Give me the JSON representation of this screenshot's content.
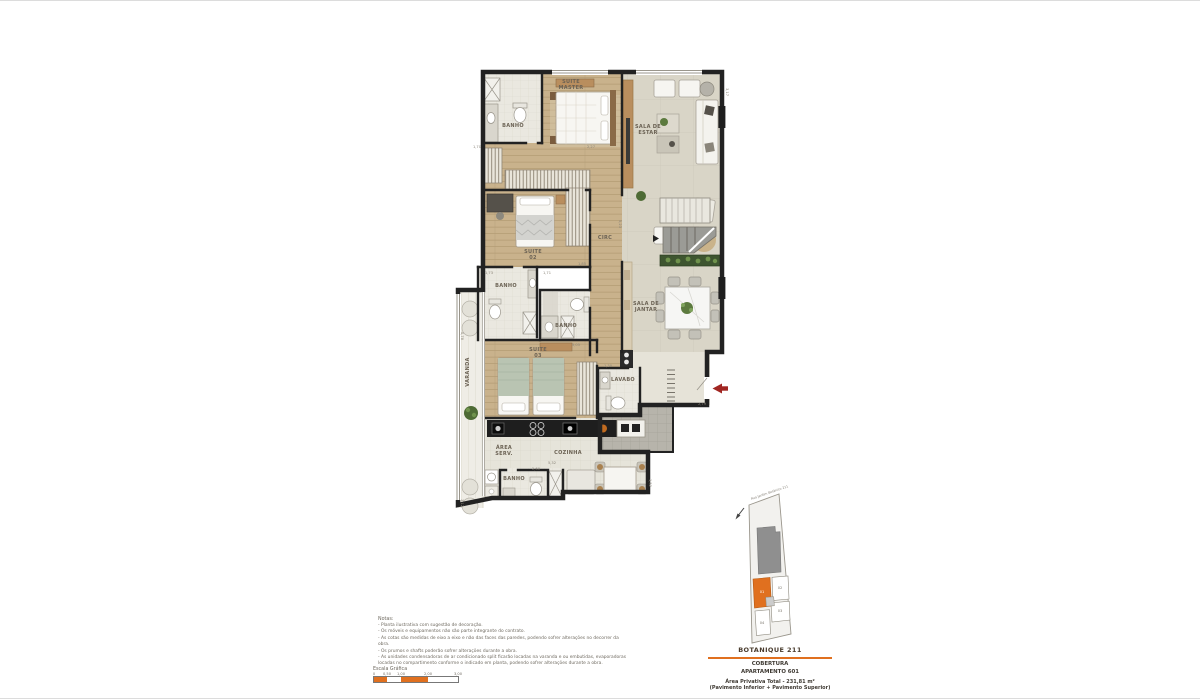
{
  "page": {
    "background": "#ffffff"
  },
  "plan": {
    "room_labels": [
      {
        "id": "suite-master",
        "lines": [
          "SUITE",
          "MASTER"
        ],
        "x": 571,
        "y": 85,
        "rot": 0
      },
      {
        "id": "banho-master",
        "lines": [
          "BANHO"
        ],
        "x": 513,
        "y": 126,
        "rot": 0
      },
      {
        "id": "sala-de-estar",
        "lines": [
          "SALA DE",
          "ESTAR"
        ],
        "x": 648,
        "y": 130,
        "rot": 0
      },
      {
        "id": "suite-02",
        "lines": [
          "SUITE",
          "02"
        ],
        "x": 533,
        "y": 255,
        "rot": 0
      },
      {
        "id": "circ",
        "lines": [
          "CIRC"
        ],
        "x": 605,
        "y": 238,
        "rot": 0
      },
      {
        "id": "banho-suite-02",
        "lines": [
          "BANHO"
        ],
        "x": 506,
        "y": 286,
        "rot": 0
      },
      {
        "id": "banho-suite-03",
        "lines": [
          "BANHO"
        ],
        "x": 566,
        "y": 326,
        "rot": 0
      },
      {
        "id": "sala-de-jantar",
        "lines": [
          "SALA DE",
          "JANTAR"
        ],
        "x": 646,
        "y": 307,
        "rot": 0
      },
      {
        "id": "varanda",
        "lines": [
          "VARANDA"
        ],
        "x": 468,
        "y": 372,
        "rot": -90
      },
      {
        "id": "suite-03",
        "lines": [
          "SUITE",
          "03"
        ],
        "x": 538,
        "y": 353,
        "rot": 0
      },
      {
        "id": "lavabo",
        "lines": [
          "LAVABO"
        ],
        "x": 623,
        "y": 380,
        "rot": 0
      },
      {
        "id": "area-serv",
        "lines": [
          "ÁREA",
          "SERV."
        ],
        "x": 504,
        "y": 451,
        "rot": 0
      },
      {
        "id": "cozinha",
        "lines": [
          "COZINHA"
        ],
        "x": 568,
        "y": 453,
        "rot": 0
      },
      {
        "id": "banho-serv",
        "lines": [
          "BANHO"
        ],
        "x": 514,
        "y": 479,
        "rot": 0
      }
    ],
    "dims": [
      {
        "t": "3,17",
        "x": 727,
        "y": 92,
        "rot": 90
      },
      {
        "t": "2,27",
        "x": 591,
        "y": 147,
        "rot": 0
      },
      {
        "t": "1,70",
        "x": 477,
        "y": 147,
        "rot": 0
      },
      {
        "t": "1,73",
        "x": 489,
        "y": 273,
        "rot": 0
      },
      {
        "t": "1,71",
        "x": 547,
        "y": 273,
        "rot": 0
      },
      {
        "t": "1,85",
        "x": 582,
        "y": 264,
        "rot": 0
      },
      {
        "t": "5,23",
        "x": 620,
        "y": 224,
        "rot": 90
      },
      {
        "t": "5,05",
        "x": 576,
        "y": 345,
        "rot": 0
      },
      {
        "t": "1,30",
        "x": 608,
        "y": 366,
        "rot": 0
      },
      {
        "t": "5,32",
        "x": 552,
        "y": 463,
        "rot": 0
      },
      {
        "t": "2,60",
        "x": 536,
        "y": 469,
        "rot": 0
      },
      {
        "t": "1,52",
        "x": 650,
        "y": 483,
        "rot": 90
      },
      {
        "t": "2,79",
        "x": 702,
        "y": 404,
        "rot": 0
      },
      {
        "t": "0,78",
        "x": 462,
        "y": 336,
        "rot": 90
      },
      {
        "t": "3,12",
        "x": 462,
        "y": 503,
        "rot": 90
      }
    ],
    "colors": {
      "wall": "#222222",
      "wood_floor": "#c9b28c",
      "social_floor": "#d9d5c7",
      "bath_floor": "#eae8e0",
      "outdoor_gray": "#b7b4ab",
      "entry_arrow": "#a12622",
      "planter_green": "#3e5530"
    }
  },
  "title_block": {
    "project": "BOTANIQUE 211",
    "type": "COBERTURA",
    "apartment": "APARTAMENTO 601",
    "area": "Área Privativa Total - 231,81 m²",
    "pavement": "(Pavimento Inferior + Pavimento Superior)",
    "accent_color": "#e0701f"
  },
  "notes": {
    "heading": "Notas:",
    "items": [
      "- Planta ilustrativa com sugestão de decoração.",
      "- Os móveis e equipamentos não são parte integrante do contrato.",
      "- As cotas são medidas de eixo a eixo e não das faces das paredes, podendo sofrer alterações no decorrer da obra.",
      "- Os prumos e shafts poderão sofrer alterações durante a obra.",
      "- As unidades condensadoras de ar condicionado split ficarão locadas na varanda e ou embutidas, evaporadoras locadas no compartimento conforme o indicado em planta, podendo sofrer alterações durante a obra."
    ]
  },
  "scale_bar": {
    "label": "Escala Gráfica",
    "segments": [
      {
        "w": 13,
        "color": "#e0701f"
      },
      {
        "w": 14,
        "color": "#ffffff"
      },
      {
        "w": 27,
        "color": "#e0701f"
      },
      {
        "w": 30,
        "color": "#ffffff"
      }
    ],
    "ticks": [
      {
        "t": "0",
        "x": 0
      },
      {
        "t": "0,50",
        "x": 13
      },
      {
        "t": "1,00",
        "x": 27
      },
      {
        "t": "2,00",
        "x": 54
      },
      {
        "t": "3,00",
        "x": 84
      }
    ]
  },
  "keyplan": {
    "street": "Rua Jardim Botânico 211",
    "highlighted_unit": "01",
    "building_color": "#8f8f8f",
    "unit_color": "#e0701f",
    "unit_labels": [
      {
        "t": "01",
        "x": 762,
        "y": 592,
        "color": "#ffffff"
      },
      {
        "t": "02",
        "x": 780,
        "y": 588,
        "color": "#7d786e"
      },
      {
        "t": "03",
        "x": 780,
        "y": 611,
        "color": "#7d786e"
      },
      {
        "t": "04",
        "x": 762,
        "y": 623,
        "color": "#7d786e"
      }
    ]
  }
}
